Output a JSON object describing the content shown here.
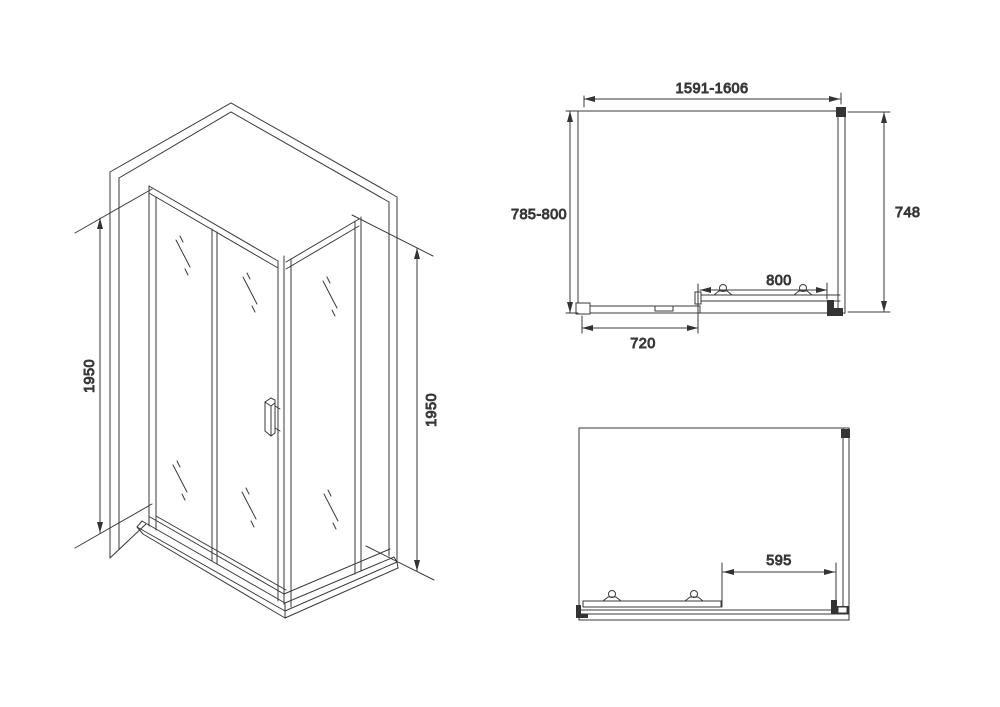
{
  "drawing_labels": {
    "iso": {
      "height_left": "1950",
      "height_right": "1950"
    },
    "top": {
      "width_range": "1591-1606",
      "depth_range": "785-800",
      "right_width": "748",
      "door_width": "800",
      "panel_width": "720"
    },
    "bottom": {
      "opening_width": "595"
    }
  }
}
